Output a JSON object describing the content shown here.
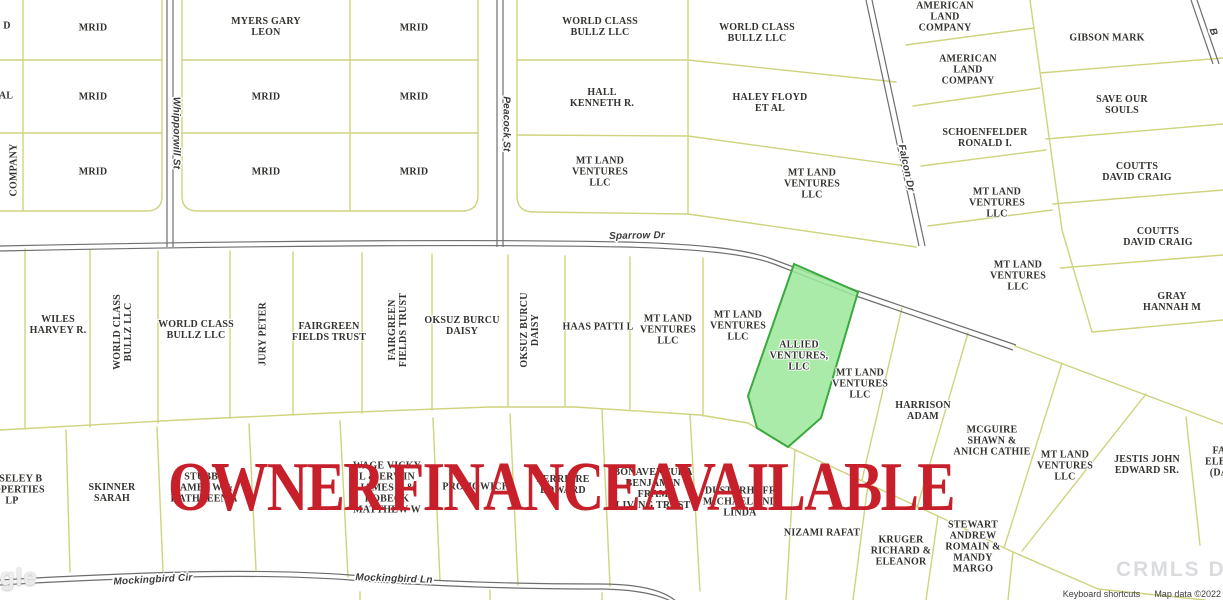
{
  "map": {
    "title_overlay": "OWNER FINANCE AVAILABLE",
    "overlay_color": "#c7202a",
    "colors": {
      "parcel_line": "#cfd37e",
      "road": "#6e6e6e",
      "background": "#ffffff"
    },
    "highlighted_parcel": {
      "name": "ALLIED VENTURES, LLC",
      "fill": "#9ce79b",
      "border": "#3aa93e"
    },
    "parcel_labels": [
      {
        "t": "D",
        "x": 7,
        "y": 26
      },
      {
        "t": "AL",
        "x": 6,
        "y": 96
      },
      {
        "t": "COMPANY",
        "x": 14,
        "y": 170,
        "r": -90
      },
      {
        "t": "MRID",
        "x": 93,
        "y": 28
      },
      {
        "t": "MRID",
        "x": 93,
        "y": 97
      },
      {
        "t": "MRID",
        "x": 93,
        "y": 172
      },
      {
        "t": "MYERS GARY\nLEON",
        "x": 266,
        "y": 27
      },
      {
        "t": "MRID",
        "x": 266,
        "y": 97
      },
      {
        "t": "MRID",
        "x": 266,
        "y": 172
      },
      {
        "t": "MRID",
        "x": 414,
        "y": 28
      },
      {
        "t": "MRID",
        "x": 414,
        "y": 97
      },
      {
        "t": "MRID",
        "x": 414,
        "y": 172
      },
      {
        "t": "WORLD CLASS\nBULLZ LLC",
        "x": 600,
        "y": 27
      },
      {
        "t": "HALL\nKENNETH R.",
        "x": 602,
        "y": 98
      },
      {
        "t": "MT LAND\nVENTURES\nLLC",
        "x": 600,
        "y": 172
      },
      {
        "t": "WORLD CLASS\nBULLZ LLC",
        "x": 757,
        "y": 33
      },
      {
        "t": "HALEY FLOYD\nET AL",
        "x": 770,
        "y": 103
      },
      {
        "t": "MT LAND\nVENTURES\nLLC",
        "x": 812,
        "y": 184
      },
      {
        "t": "AMERICAN\nLAND\nCOMPANY",
        "x": 945,
        "y": 17
      },
      {
        "t": "AMERICAN\nLAND\nCOMPANY",
        "x": 968,
        "y": 70
      },
      {
        "t": "SCHOENFELDER\nRONALD I.",
        "x": 985,
        "y": 138
      },
      {
        "t": "MT LAND\nVENTURES\nLLC",
        "x": 997,
        "y": 203
      },
      {
        "t": "GIBSON MARK",
        "x": 1107,
        "y": 38
      },
      {
        "t": "SAVE OUR\nSOULS",
        "x": 1122,
        "y": 105
      },
      {
        "t": "COUTTS\nDAVID CRAIG",
        "x": 1137,
        "y": 172
      },
      {
        "t": "MT LAND\nVENTURES\nLLC",
        "x": 1018,
        "y": 276
      },
      {
        "t": "COUTTS\nDAVID CRAIG",
        "x": 1158,
        "y": 237
      },
      {
        "t": "GRAY\nHANNAH M",
        "x": 1172,
        "y": 302
      },
      {
        "t": "WILES\nHARVEY R.",
        "x": 58,
        "y": 325
      },
      {
        "t": "WORLD CLASS\nBULLZ LLC",
        "x": 123,
        "y": 332,
        "r": -90
      },
      {
        "t": "WORLD CLASS\nBULLZ LLC",
        "x": 196,
        "y": 330
      },
      {
        "t": "JURY PETER",
        "x": 263,
        "y": 334,
        "r": -90
      },
      {
        "t": "FAIRGREEN\nFIELDS TRUST",
        "x": 329,
        "y": 332
      },
      {
        "t": "FAIRGREEN\nFIELDS TRUST",
        "x": 398,
        "y": 330,
        "r": -90
      },
      {
        "t": "OKSUZ BURCU\nDAISY",
        "x": 462,
        "y": 326
      },
      {
        "t": "OKSUZ BURCU\nDAISY",
        "x": 530,
        "y": 330,
        "r": -90
      },
      {
        "t": "HAAS PATTI L",
        "x": 598,
        "y": 327
      },
      {
        "t": "MT LAND\nVENTURES\nLLC",
        "x": 668,
        "y": 330
      },
      {
        "t": "MT LAND\nVENTURES\nLLC",
        "x": 738,
        "y": 326
      },
      {
        "t": "ALLIED\nVENTURES,\nLLC",
        "x": 799,
        "y": 356
      },
      {
        "t": "MT LAND\nVENTURES\nLLC",
        "x": 860,
        "y": 384
      },
      {
        "t": "HARRISON\nADAM",
        "x": 923,
        "y": 411
      },
      {
        "t": "MCGUIRE\nSHAWN &\nANICH CATHIE",
        "x": 992,
        "y": 441
      },
      {
        "t": "MT LAND\nVENTURES\nLLC",
        "x": 1065,
        "y": 466
      },
      {
        "t": "JESTIS JOHN\nEDWARD SR.",
        "x": 1147,
        "y": 465
      },
      {
        "t": "FA\nELEA\n(DA",
        "x": 1219,
        "y": 462
      },
      {
        "t": "MOSELEY B\nPROPERTIES\nLP",
        "x": 12,
        "y": 490
      },
      {
        "t": "SKINNER\nSARAH",
        "x": 112,
        "y": 493
      },
      {
        "t": "STUBBS\nJAMES W &\nKATHLEEN A",
        "x": 204,
        "y": 488
      },
      {
        "t": "WAGE VICKY\nL & ERWIN\nJAMES E &\nROBECK\nMATTHEW W",
        "x": 387,
        "y": 488
      },
      {
        "t": "PROHOWICH",
        "x": 476,
        "y": 487
      },
      {
        "t": "FERREIRE\nEDWARD",
        "x": 563,
        "y": 485
      },
      {
        "t": "BONAVENTURA\nBENJAMIN\nFRAM\nLIVING TRUST",
        "x": 653,
        "y": 489
      },
      {
        "t": "DUSTERHOFF\nMICHAEL AND\nLINDA",
        "x": 740,
        "y": 502
      },
      {
        "t": "NIZAMI RAFAT",
        "x": 822,
        "y": 533
      },
      {
        "t": "KRUGER\nRICHARD &\nELEANOR",
        "x": 901,
        "y": 551
      },
      {
        "t": "STEWART\nANDREW\nROMAIN &\nMANDY\nMARGO",
        "x": 973,
        "y": 547
      }
    ],
    "street_labels": [
      {
        "t": "Whipporwill St",
        "x": 176,
        "y": 133,
        "r": 90
      },
      {
        "t": "Peacock St",
        "x": 506,
        "y": 124,
        "r": 90
      },
      {
        "t": "Sparrow Dr",
        "x": 637,
        "y": 236,
        "r": -1
      },
      {
        "t": "Falcon Dr",
        "x": 906,
        "y": 168,
        "r": 78
      },
      {
        "t": "B",
        "x": 1213,
        "y": 32,
        "r": 70
      },
      {
        "t": "Mockingbird Cir",
        "x": 153,
        "y": 580,
        "r": -3
      },
      {
        "t": "Mockingbird Ln",
        "x": 394,
        "y": 579,
        "r": 2
      }
    ],
    "attribution": {
      "keyboard_shortcuts": "Keyboard shortcuts",
      "map_data": "Map data ©2022"
    },
    "google_logo_partial": "gle",
    "watermark": "CRMLS DE"
  }
}
